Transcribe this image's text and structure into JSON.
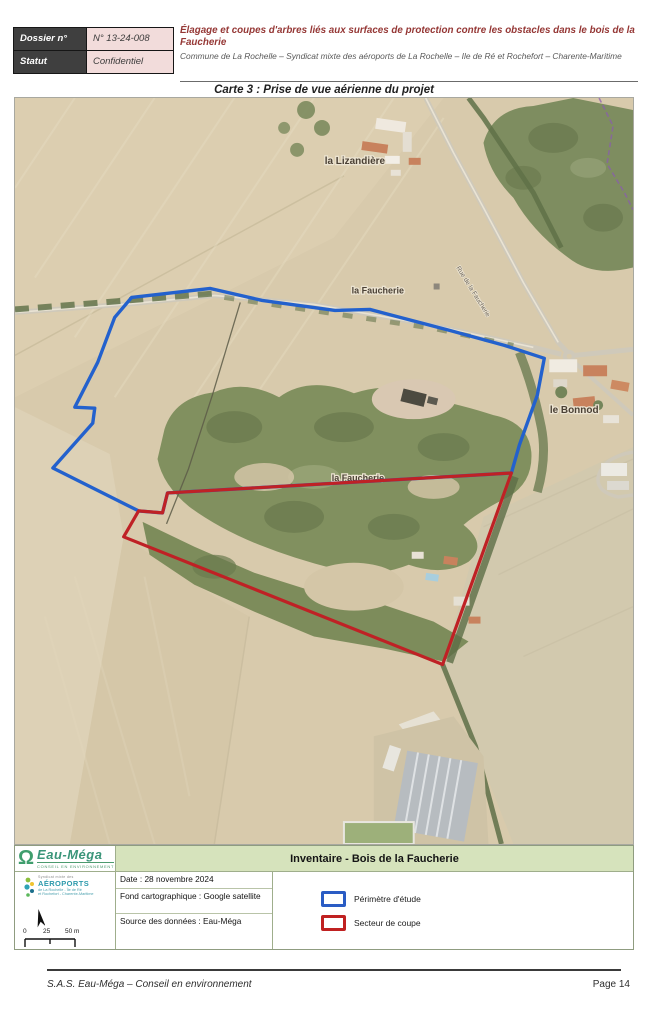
{
  "header": {
    "rows": [
      {
        "label": "Dossier n°",
        "value": "N° 13-24-008"
      },
      {
        "label": "Statut",
        "value": "Confidentiel"
      }
    ],
    "title": "Élagage et coupes d'arbres liés aux surfaces de protection contre les obstacles dans le bois de la Faucherie",
    "subtitle": "Commune de La Rochelle – Syndicat mixte des aéroports de La Rochelle – Ile de Ré et Rochefort – Charente-Maritime"
  },
  "caption": "Carte 3 : Prise de vue aérienne du projet",
  "map": {
    "labels": {
      "lizandiere": "la Lizandière",
      "faucherie_top": "la Faucherie",
      "faucherie_mid": "la Faucherie",
      "bonnod": "le Bonnod",
      "road": "Rue de la Faucherie"
    },
    "colors": {
      "perimetre_bleu": "#2361cd",
      "secteur_rouge": "#bf2125"
    }
  },
  "legend": {
    "banner": "Inventaire - Bois de la Faucherie",
    "eaumega": {
      "omega": "Ω",
      "name": "Eau-Méga",
      "sub": "Conseil en Environnement"
    },
    "aeroports": {
      "top": "Syndicat mixte des",
      "name": "AÉROPORTS",
      "sub1": "de La Rochelle - Île de Ré",
      "sub2": "et Rochefort - Charente-Maritime"
    },
    "info": {
      "date": "Date : 28 novembre 2024",
      "fond": "Fond cartographique : Google satellite",
      "source": "Source des données : Eau-Méga"
    },
    "items": [
      {
        "label": "Périmètre d'étude",
        "color": "#2a5cc4"
      },
      {
        "label": "Secteur de coupe",
        "color": "#c02121"
      }
    ],
    "scalebar": {
      "t0": "0",
      "t1": "25",
      "t2": "50 m"
    }
  },
  "footer": {
    "left": "S.A.S. Eau-Méga – Conseil en environnement",
    "right": "Page 14"
  }
}
